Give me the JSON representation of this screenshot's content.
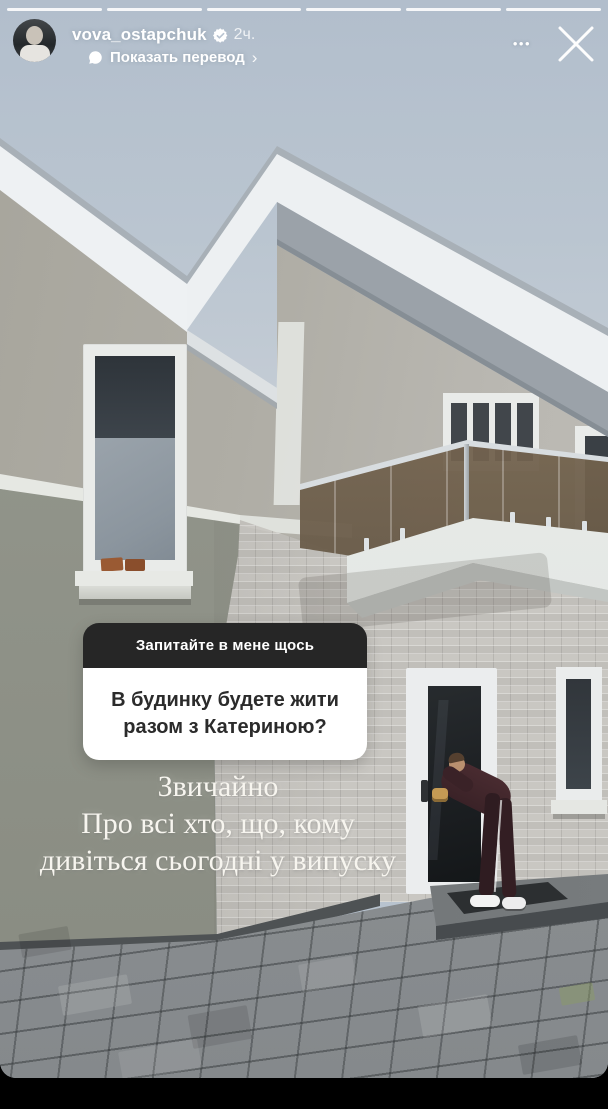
{
  "colors": {
    "sticker_header_bg": "#262626",
    "sticker_body_bg": "#ffffff",
    "sticker_title_text": "#ffffff",
    "sticker_question_text": "#2b2b2b",
    "caption_text": "#f7f5ef",
    "ui_text": "#ffffff",
    "progress_bar": "#ffffff"
  },
  "progress": {
    "segments": 6
  },
  "header": {
    "username": "vova_ostapchuk",
    "verified": true,
    "timestamp": "2ч.",
    "translate_label": "Показать перевод",
    "chevron_icon": "›",
    "more_icon": "•••",
    "close_icon": "✕",
    "translate_icon": "speech-bubble",
    "verified_icon": "verified-badge"
  },
  "sticker": {
    "title": "Запитайте в мене щось",
    "question": "В будинку будете жити разом з Катериною?"
  },
  "caption": {
    "lines": [
      "Звичайно",
      "Про всі хто, що, кому",
      "дивіться сьогодні у випуску"
    ]
  }
}
